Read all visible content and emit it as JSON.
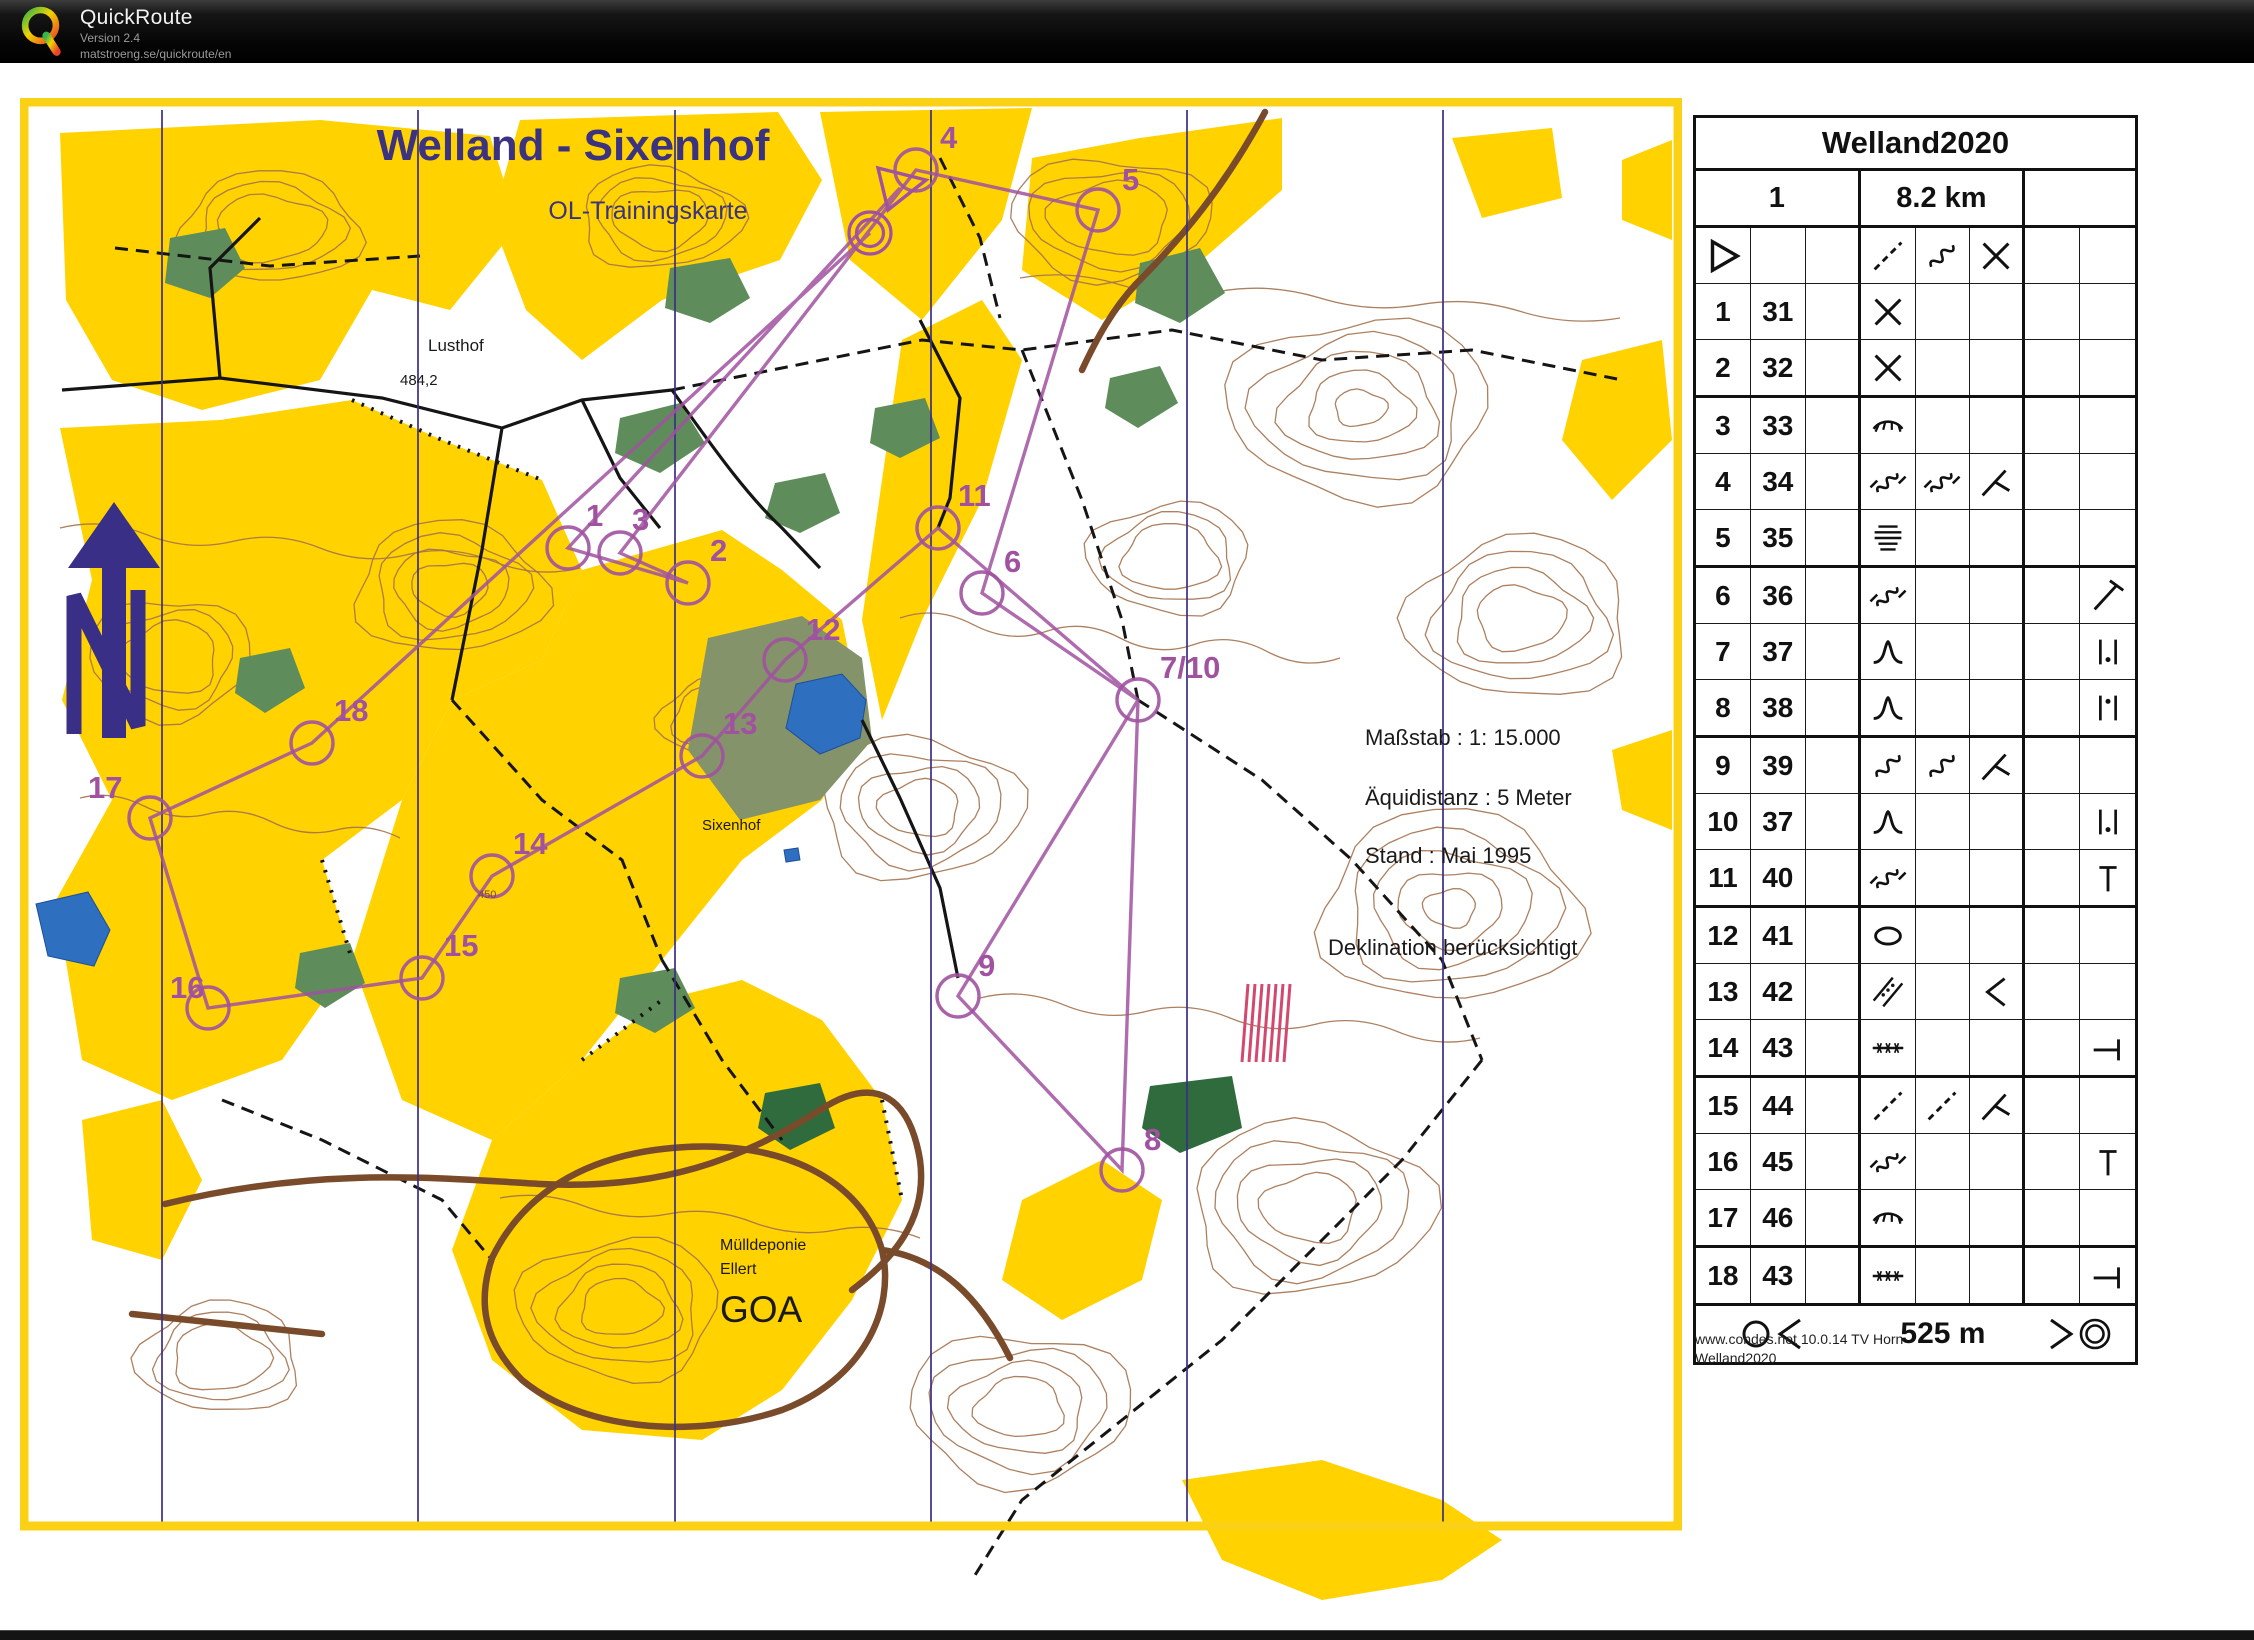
{
  "header": {
    "app_name": "QuickRoute",
    "version": "Version 2.4",
    "url": "matstroeng.se/quickroute/en"
  },
  "map": {
    "title": "Welland - Sixenhof",
    "subtitle": "OL-Trainingskarte",
    "labels": {
      "lusthof": "Lusthof",
      "spot_height": "484,2",
      "sixenhof": "Sixenhof",
      "contour_value": "450",
      "muelldeponie": "Mülldeponie",
      "ellert": "Ellert",
      "goa": "GOA"
    },
    "info_block": {
      "scale": "Maßstab : 1: 15.000",
      "equidistance": "Äquidistanz : 5 Meter",
      "state": "Stand : Mai 1995",
      "declination": "Deklination berücksichtigt"
    },
    "colors": {
      "open_land": "#FFD200",
      "contour_brown": "#A4724E",
      "course_purple": "#A052A0",
      "water_blue": "#2E6FC0",
      "north_line": "#3A2F86",
      "frame_yellow": "#FBD116",
      "road_brown": "#7A4B2B",
      "green": "#5E8C5A",
      "dark_green": "#2F6B3C"
    },
    "course": {
      "start": {
        "x": 880,
        "y": 90
      },
      "finish": {
        "x": 850,
        "y": 135
      },
      "sequence": [
        "start",
        "1",
        "2",
        "3",
        "4",
        "5",
        "6",
        "7/10",
        "8",
        "9",
        "7/10",
        "11",
        "12",
        "13",
        "14",
        "15",
        "16",
        "17",
        "18",
        "finish"
      ],
      "controls": [
        {
          "label": "1",
          "cx": 548,
          "cy": 450,
          "lx": 566,
          "ly": 428
        },
        {
          "label": "2",
          "cx": 668,
          "cy": 485,
          "lx": 690,
          "ly": 463
        },
        {
          "label": "3",
          "cx": 600,
          "cy": 455,
          "lx": 612,
          "ly": 432
        },
        {
          "label": "4",
          "cx": 896,
          "cy": 72,
          "lx": 920,
          "ly": 50
        },
        {
          "label": "5",
          "cx": 1078,
          "cy": 112,
          "lx": 1102,
          "ly": 92
        },
        {
          "label": "6",
          "cx": 962,
          "cy": 495,
          "lx": 984,
          "ly": 474
        },
        {
          "label": "7/10",
          "cx": 1118,
          "cy": 602,
          "lx": 1140,
          "ly": 580
        },
        {
          "label": "8",
          "cx": 1102,
          "cy": 1072,
          "lx": 1124,
          "ly": 1052
        },
        {
          "label": "9",
          "cx": 938,
          "cy": 898,
          "lx": 958,
          "ly": 878
        },
        {
          "label": "11",
          "cx": 918,
          "cy": 430,
          "lx": 938,
          "ly": 408
        },
        {
          "label": "12",
          "cx": 765,
          "cy": 562,
          "lx": 786,
          "ly": 542
        },
        {
          "label": "13",
          "cx": 682,
          "cy": 658,
          "lx": 703,
          "ly": 636
        },
        {
          "label": "14",
          "cx": 472,
          "cy": 778,
          "lx": 493,
          "ly": 756
        },
        {
          "label": "15",
          "cx": 402,
          "cy": 880,
          "lx": 424,
          "ly": 858
        },
        {
          "label": "16",
          "cx": 188,
          "cy": 910,
          "lx": 150,
          "ly": 900
        },
        {
          "label": "17",
          "cx": 130,
          "cy": 720,
          "lx": 68,
          "ly": 700
        },
        {
          "label": "18",
          "cx": 292,
          "cy": 645,
          "lx": 314,
          "ly": 623
        }
      ]
    }
  },
  "control_sheet": {
    "title": "Welland2020",
    "course_number": "1",
    "course_length": "8.2 km",
    "columns": 8,
    "rows": [
      {
        "no": "",
        "code": "",
        "a": "start-triangle",
        "d": "dashed-line",
        "e": "squiggle",
        "f": "cross"
      },
      {
        "no": "1",
        "code": "31",
        "d": "cross"
      },
      {
        "no": "2",
        "code": "32",
        "d": "cross"
      },
      {
        "no": "3",
        "code": "33",
        "d": "veg-boundary"
      },
      {
        "no": "4",
        "code": "34",
        "d": "gully",
        "e": "gully",
        "f": "junction-y"
      },
      {
        "no": "5",
        "code": "35",
        "d": "terrace"
      },
      {
        "no": "6",
        "code": "36",
        "d": "gully",
        "h": "diag-t"
      },
      {
        "no": "7",
        "code": "37",
        "d": "knoll",
        "h": "between-dot-low"
      },
      {
        "no": "8",
        "code": "38",
        "d": "knoll",
        "h": "between-dot-high"
      },
      {
        "no": "9",
        "code": "39",
        "d": "squiggle",
        "e": "squiggle",
        "f": "junction-y"
      },
      {
        "no": "10",
        "code": "37",
        "d": "knoll",
        "h": "between-dot-low"
      },
      {
        "no": "11",
        "code": "40",
        "d": "gully",
        "h": "t-top"
      },
      {
        "no": "12",
        "code": "41",
        "d": "oval"
      },
      {
        "no": "13",
        "code": "42",
        "d": "ride",
        "f": "bend"
      },
      {
        "no": "14",
        "code": "43",
        "d": "fence",
        "h": "end-bar"
      },
      {
        "no": "15",
        "code": "44",
        "d": "dashed-line",
        "e": "dashed-line",
        "f": "junction-y"
      },
      {
        "no": "16",
        "code": "45",
        "d": "gully",
        "h": "t-top"
      },
      {
        "no": "17",
        "code": "46",
        "d": "veg-boundary"
      },
      {
        "no": "18",
        "code": "43",
        "d": "fence",
        "h": "end-bar"
      }
    ],
    "footer": {
      "left_symbol": "circle-chevron-left",
      "distance": "525 m",
      "right_symbol": "chevron-double-circle"
    }
  },
  "credits": {
    "line1": "www.condes.net 10.0.14 TV Horn",
    "line2": "Welland2020"
  }
}
